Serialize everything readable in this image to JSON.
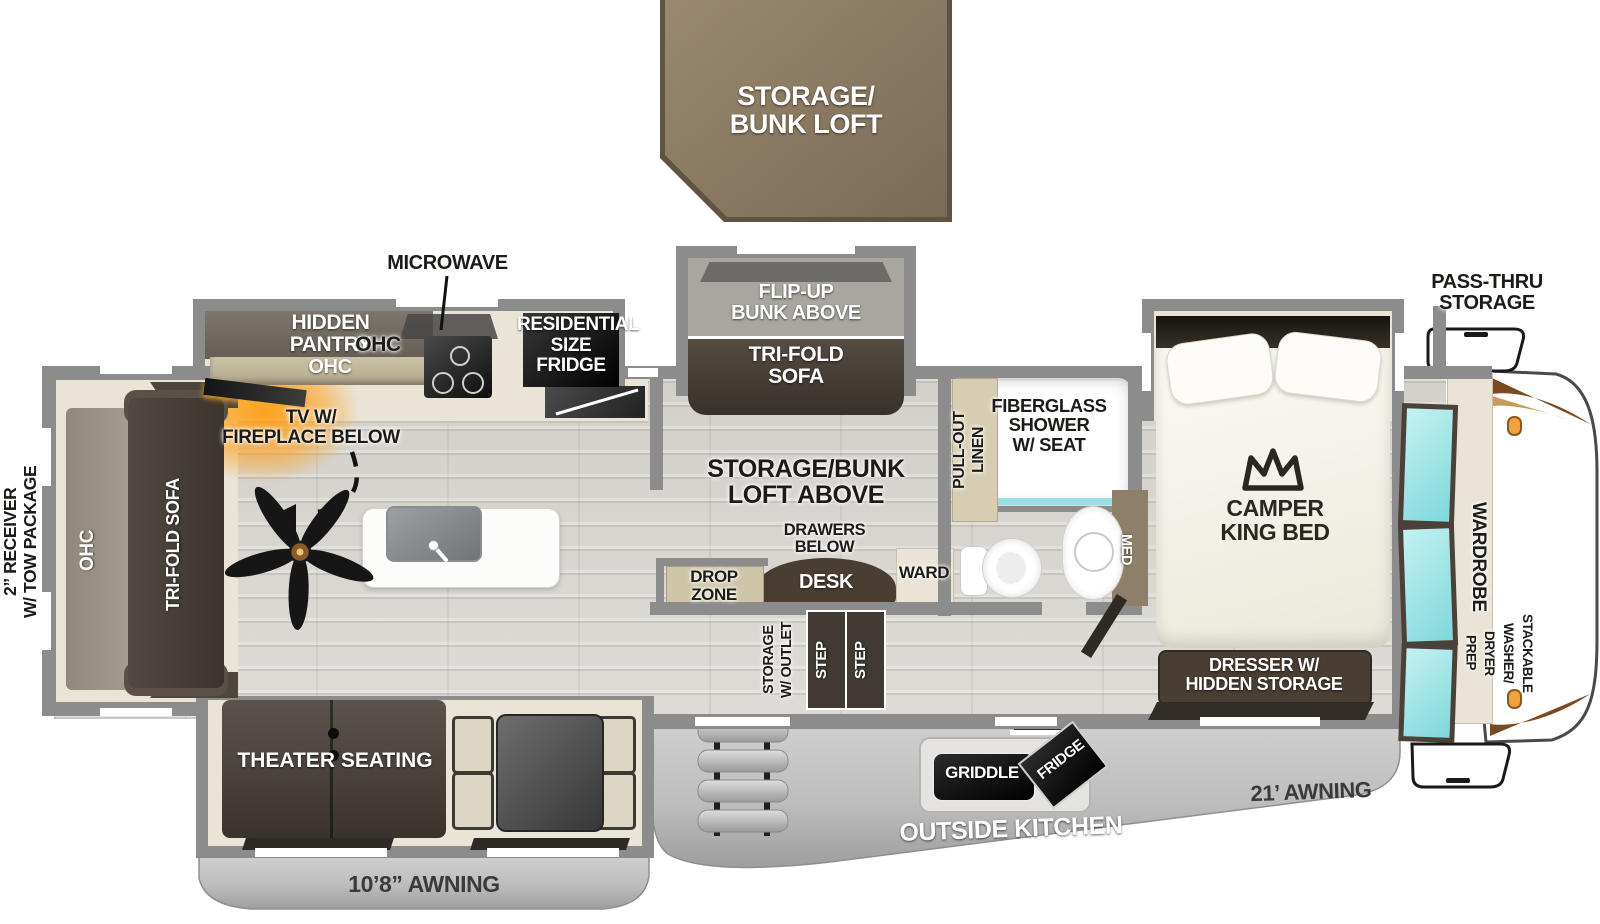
{
  "title": "Travel trailer floor plan",
  "colors": {
    "wall": "#8c8c8c",
    "loft_brown": "#8a7764",
    "furniture_dark": "#473f36",
    "cabinet_tan": "#d2c9ae",
    "cream": "#e9e4d6",
    "mirror_cyan": "#8fdce0",
    "awning_gray": "#c2c2c2",
    "accent_orange": "#f2a13c",
    "fireplace_glow": "#ff9d1e"
  },
  "labels": {
    "loft": "STORAGE/\nBUNK LOFT",
    "microwave": "MICROWAVE",
    "hidden_pantry": "HIDDEN\nPANTRY",
    "ohc_pantry": "OHC",
    "ohc_kitchen": "OHC",
    "residential_fridge": "RESIDENTIAL\nSIZE\nFRIDGE",
    "flip_up_bunk": "FLIP-UP\nBUNK ABOVE",
    "tri_fold_sofa_bunk": "TRI-FOLD\nSOFA",
    "tv_fireplace": "TV W/\nFIREPLACE BELOW",
    "loft_above": "STORAGE/BUNK\nLOFT ABOVE",
    "drawers_below": "DRAWERS\nBELOW",
    "desk": "DESK",
    "ward": "WARD",
    "drop_zone": "DROP\nZONE",
    "storage_outlet": "STORAGE\nW/ OUTLET",
    "step": "STEP",
    "pull_out_linen": "PULL-OUT\nLINEN",
    "shower": "FIBERGLASS\nSHOWER\nW/ SEAT",
    "med": "MED",
    "camper_king_bed": "CAMPER\nKING BED",
    "pass_thru": "PASS-THRU\nSTORAGE",
    "wardrobe": "WARDROBE",
    "washer_prep": "STACKABLE\nWASHER/\nDRYER\nPREP",
    "dresser": "DRESSER W/\nHIDDEN STORAGE",
    "receiver": "2” RECEIVER\nW/ TOW PACKAGE",
    "ohc_rear": "OHC",
    "tri_fold_sofa_rear": "TRI-FOLD SOFA",
    "theater": "THEATER SEATING",
    "awning_left": "10’8” AWNING",
    "awning_right": "21’ AWNING",
    "outside_kitchen": "OUTSIDE KITCHEN",
    "griddle": "GRIDDLE",
    "fridge_outside": "FRIDGE"
  }
}
